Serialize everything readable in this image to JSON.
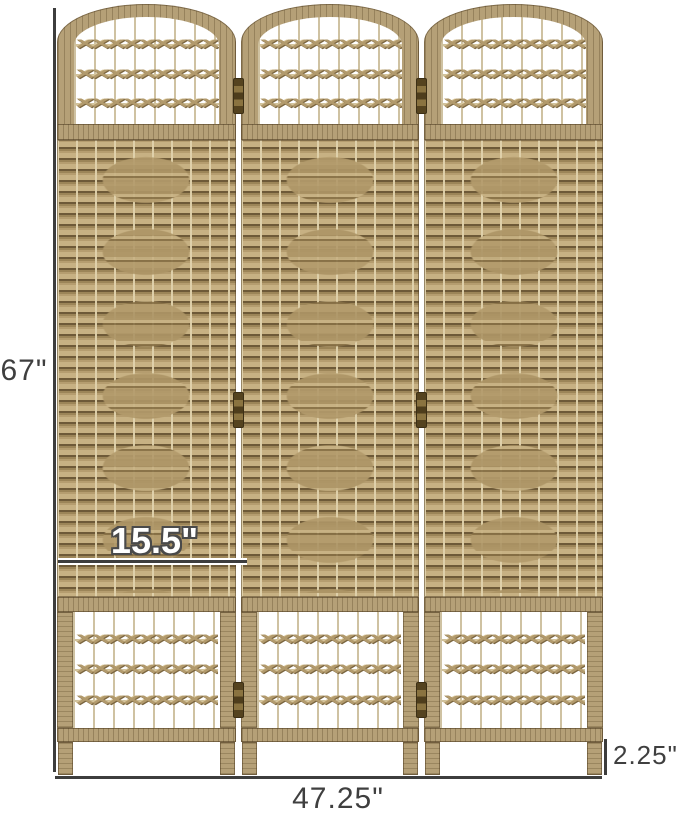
{
  "dimensions": {
    "height": "67\"",
    "panel_width": "15.5\"",
    "total_width": "47.25\"",
    "leg_height": "2.25\""
  },
  "decor": {
    "knot_row": "✕✕✕✕✕✕✕✕✕"
  },
  "colors": {
    "frame_wood": "#b5a077",
    "weave_base": "#a58f64",
    "weave_shadow": "#6e5a38",
    "string": "#cfc2a2",
    "dimension_line": "#3d3d3d",
    "label_text": "#3f3f3f",
    "panel_width_label_fill": "#ffffff",
    "background": "#ffffff"
  }
}
